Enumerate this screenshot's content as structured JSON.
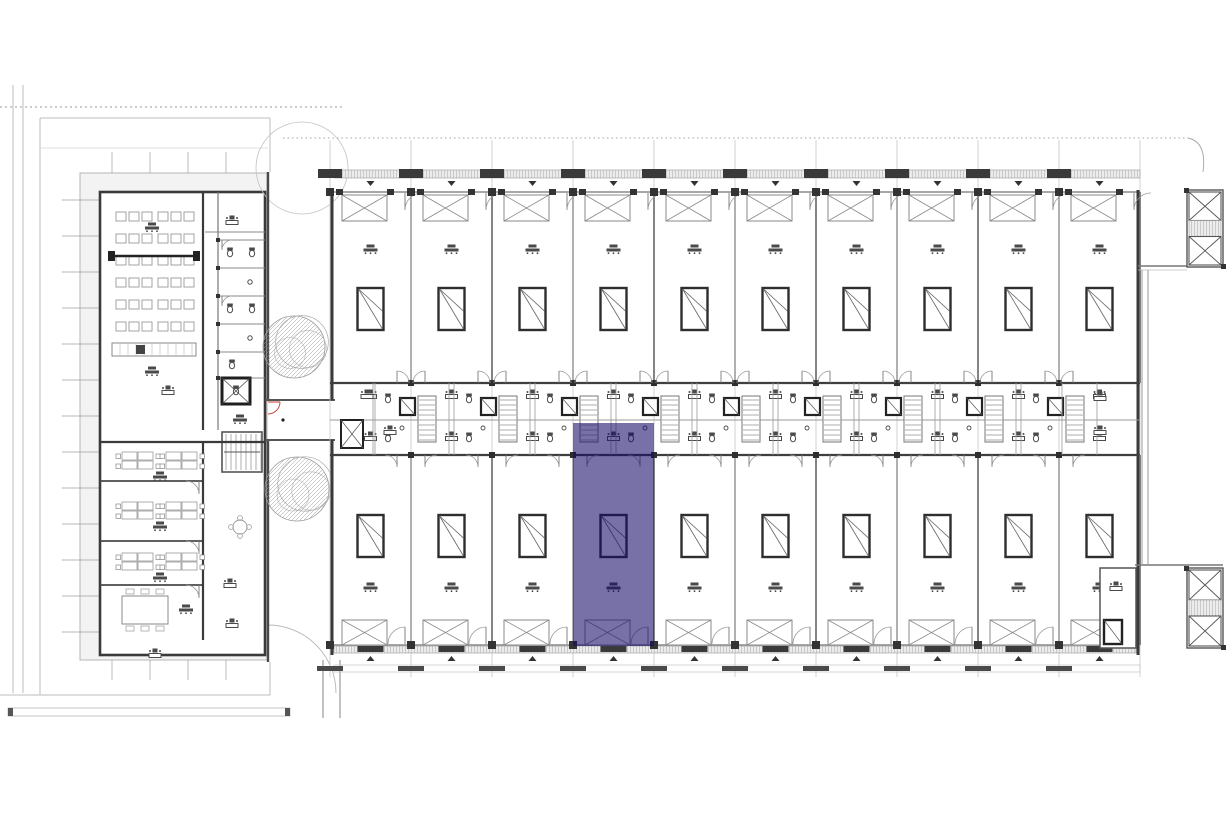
{
  "plan": {
    "kind": "architectural-floor-plan",
    "canvas": {
      "w": 1230,
      "h": 820
    },
    "colors": {
      "paper": "#ffffff",
      "wall_dark": "#3a3a3a",
      "wall_mid": "#6e6e6e",
      "line_med": "#8a8a8a",
      "line_light": "#bdbdbd",
      "line_faint": "#d4d4d4",
      "band_fill": "#e9e9e9",
      "building_band": "#f3f3f3",
      "glyph": "#4a4a4a",
      "accent_red": "#c23b32",
      "highlight_fill": "#140A69",
      "highlight_opacity": 0.58,
      "highlight_rendered": "#7B76AC"
    },
    "site": {
      "street_lines_x": [
        13,
        23
      ],
      "street_lines_y0": 85,
      "street_lines_y1": 693,
      "dashed_top_y": 107,
      "dashed_top_x0": 0,
      "dashed_top_x1": 345,
      "dashed_mid_y": 138,
      "dashed_mid_x0": 283,
      "dashed_mid_x1": 1188,
      "parcel": {
        "x0": 40,
        "y0": 118,
        "x1": 270,
        "y1": 695,
        "inner_y": 148
      },
      "bottom_line_y": 695,
      "bottom_band": {
        "x0": 8,
        "y0": 708,
        "x1": 290,
        "y1": 716
      },
      "drive_arc": {
        "cx": 268,
        "cy": 625,
        "r": 68
      },
      "below_walls_x": [
        323,
        340
      ],
      "below_walls_y0": 660,
      "below_walls_y1": 718
    },
    "left_building": {
      "band": {
        "x": 80,
        "y": 173,
        "w": 187,
        "h": 487
      },
      "shell": {
        "x": 100,
        "y": 192,
        "w": 165,
        "h": 463
      },
      "lecture": {
        "seat_rows": 6,
        "seat_row_y0": 212,
        "seat_row_step": 22,
        "seat_groups_x": [
          116,
          158
        ],
        "seats_per_group": 3,
        "seat_w": 10,
        "seat_h": 9,
        "seat_step": 13,
        "beam_y": 256,
        "counter": {
          "x": 112,
          "y": 343,
          "w": 84,
          "h": 13
        }
      },
      "core": {
        "x": 218,
        "y0": 192,
        "y1": 430,
        "wc_partition_ys": [
          240,
          268,
          296,
          324,
          352,
          378
        ],
        "elevator": {
          "x": 222,
          "y": 378,
          "w": 28,
          "h": 26
        },
        "stair": {
          "x": 222,
          "y": 432,
          "w": 40,
          "h": 40
        },
        "round_table": {
          "cx": 240,
          "cy": 527,
          "r": 7
        }
      },
      "offices": {
        "x0": 100,
        "x1": 203,
        "partition_ys": [
          442,
          481,
          541,
          585,
          640
        ],
        "cluster_xs": [
          138,
          182
        ],
        "meeting_table": {
          "x": 122,
          "y": 596,
          "w": 46,
          "h": 28
        }
      },
      "tick_step": 36
    },
    "courtyard": {
      "x0": 268,
      "x1": 332,
      "corridor": {
        "y0": 400,
        "y1": 440
      },
      "trees": [
        {
          "cx": 294,
          "cy": 347,
          "r": 31
        },
        {
          "cx": 297,
          "cy": 489,
          "r": 32
        }
      ],
      "canopy_circle": {
        "cx": 302,
        "cy": 168,
        "r": 46
      },
      "red_door": {
        "x": 268,
        "y": 402,
        "r": 12
      }
    },
    "right_building": {
      "x0": 330,
      "x1": 1140,
      "bay_count": 10,
      "bay_w": 81,
      "grid_y0": 140,
      "grid_y1": 677,
      "top_band": {
        "y": 170,
        "h": 8
      },
      "top_wall_y": 192,
      "bottom_wall_y": 645,
      "bottom_band": {
        "y": 646,
        "h": 7
      },
      "dash_band": {
        "y": 665,
        "h": 7
      },
      "service_band": {
        "y0": 383,
        "y1": 455,
        "mid_y": 420
      },
      "xbox": {
        "dx": 12,
        "w": 45,
        "top_y": 195,
        "top_h": 26,
        "bot_y": 620,
        "bot_h": 25
      },
      "window": {
        "w": 26,
        "h": 42,
        "top_y": 288,
        "bot_y": 515
      },
      "label_top_y": 250,
      "label_bot_y": 588,
      "door_r": 17,
      "corner_room": {
        "x": 1100,
        "y": 568,
        "w": 36,
        "h": 80
      }
    },
    "highlight_unit": {
      "bay_index": 4,
      "x": 573,
      "y": 423,
      "w": 81,
      "h": 223,
      "state": "selected"
    },
    "towers": {
      "top": {
        "x": 1187,
        "y": 190,
        "w": 36,
        "h": 77,
        "connector_y": 266
      },
      "bottom": {
        "x": 1187,
        "y": 568,
        "w": 36,
        "h": 80,
        "connector_y": 565
      },
      "link_wall_x": [
        1142,
        1148
      ],
      "hook": {
        "x0": 1188,
        "y0": 138,
        "x1": 1203,
        "y1": 172
      }
    }
  }
}
